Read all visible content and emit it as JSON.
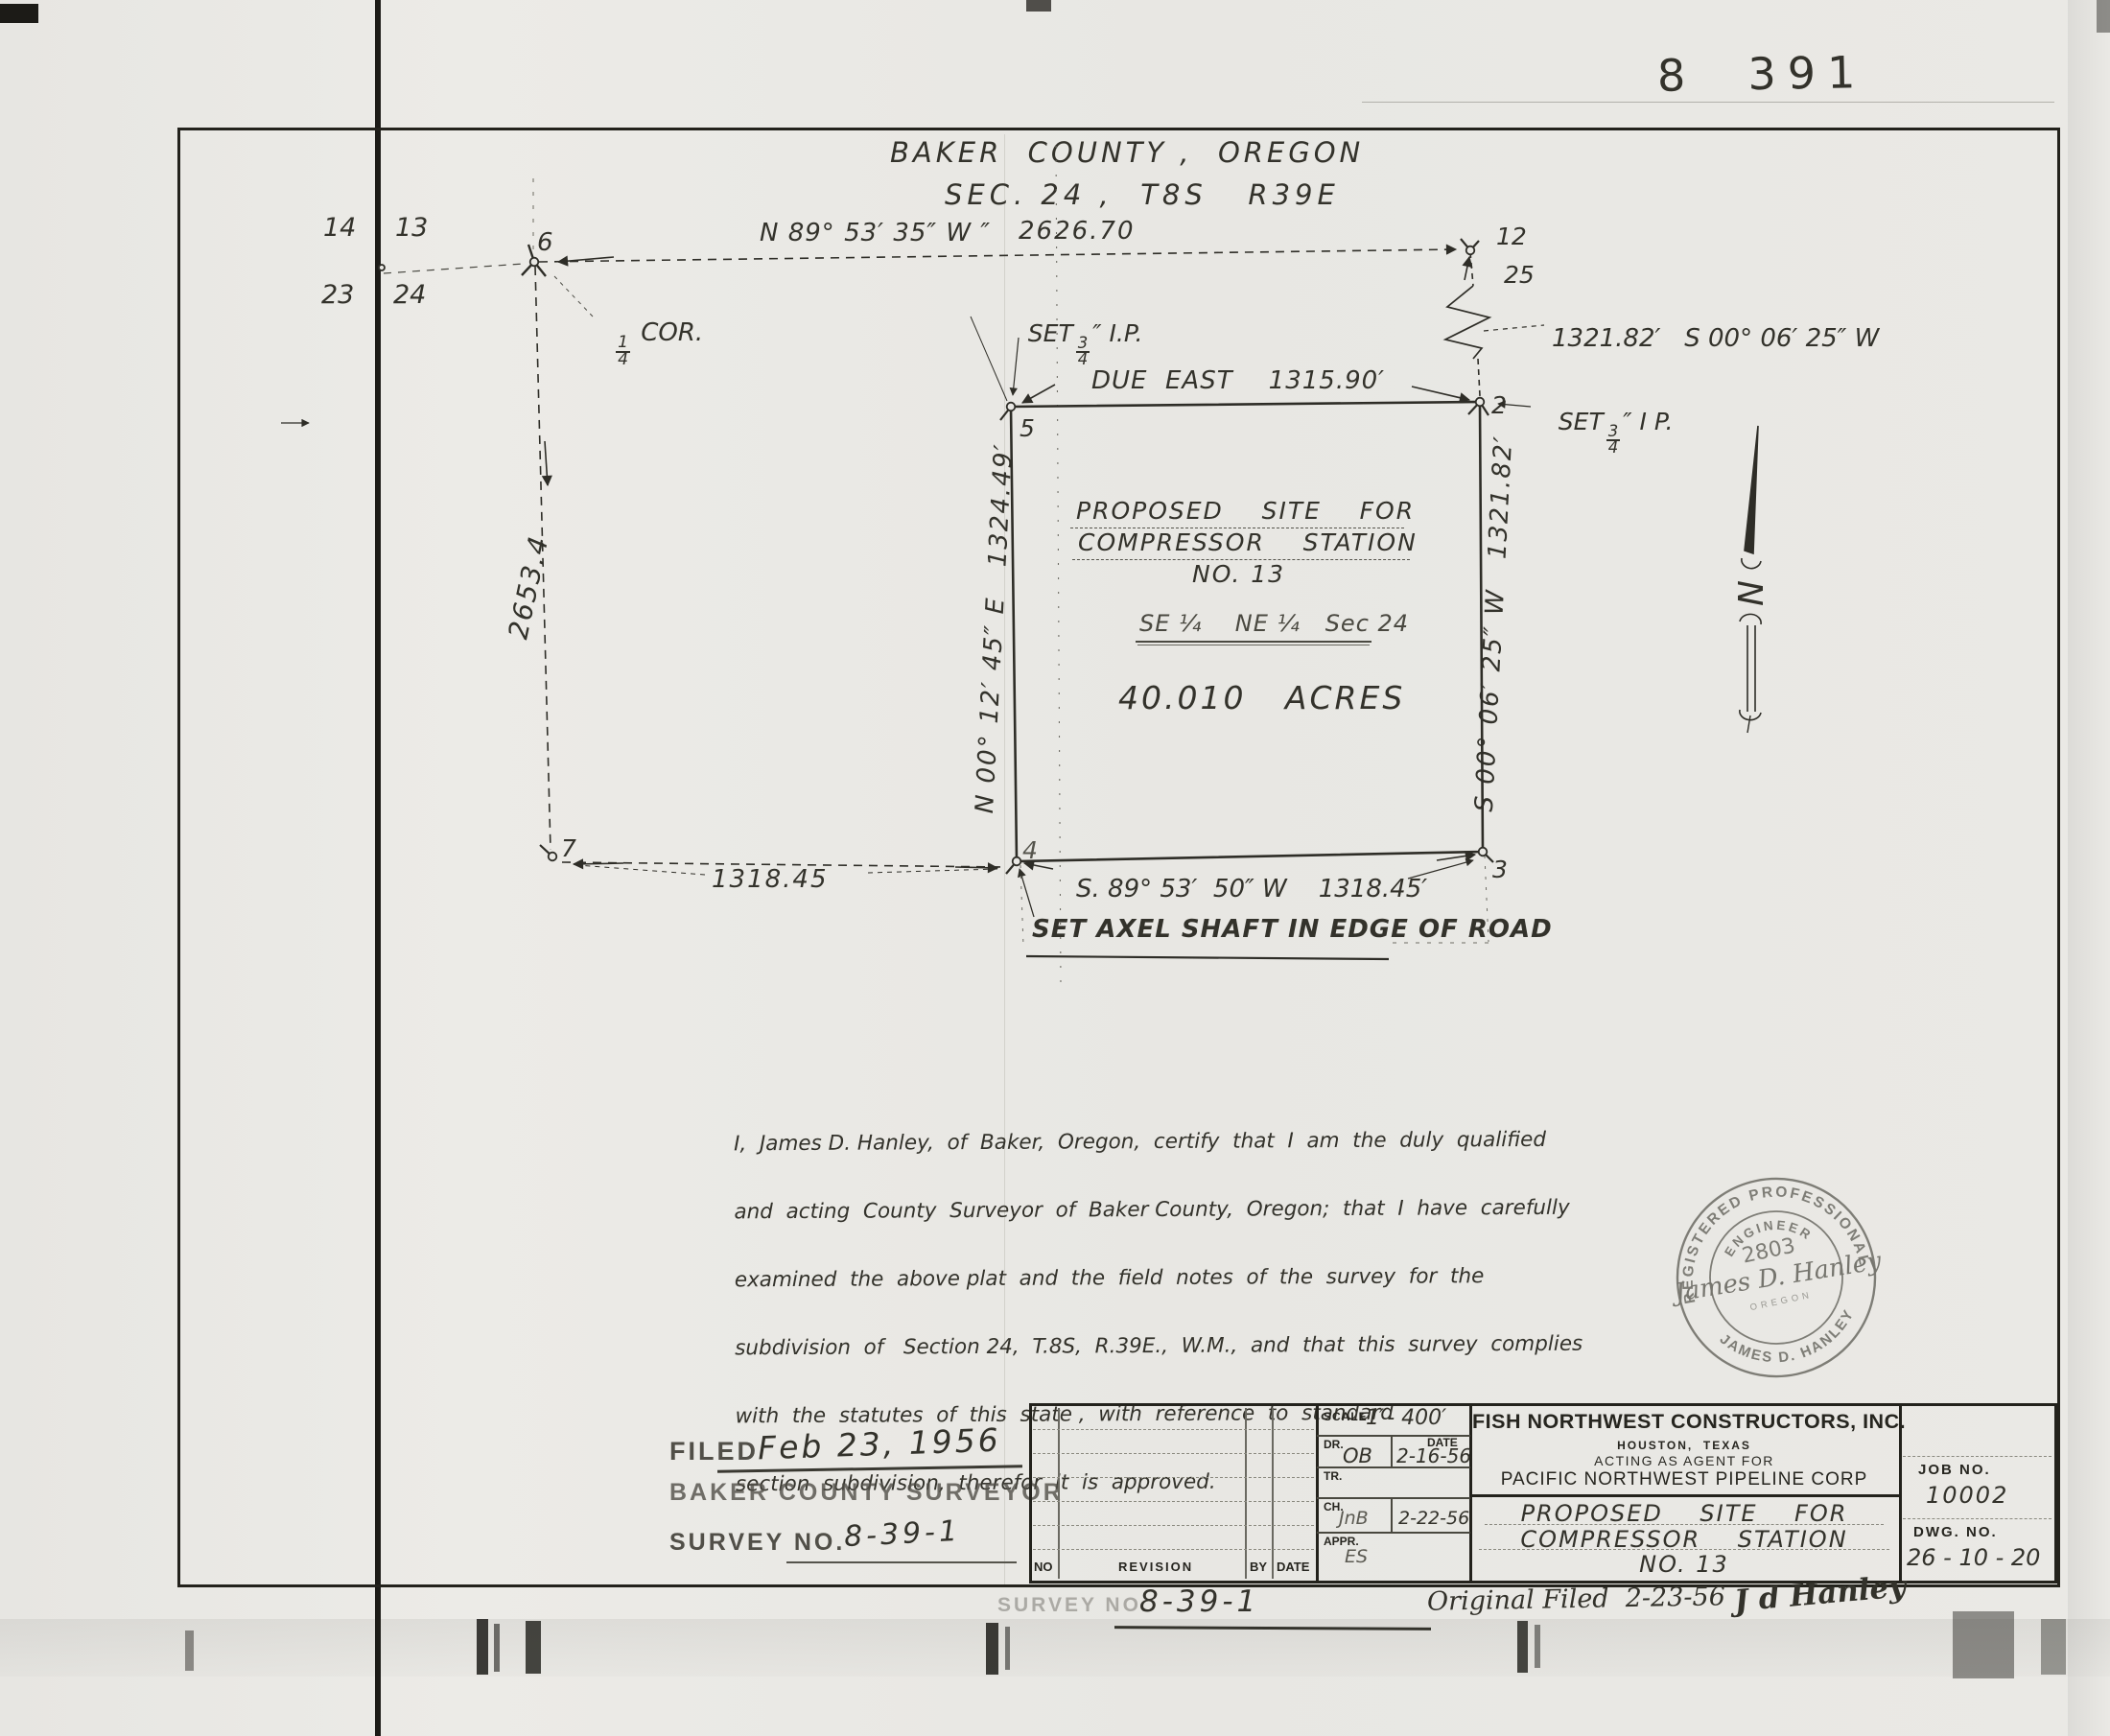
{
  "scan": {
    "sheet_number": "8  391"
  },
  "title": {
    "line1": "BAKER  COUNTY ,  OREGON",
    "line2": "SEC. 24 ,  T8S   R39E"
  },
  "sections": {
    "nw": "14",
    "ne": "13",
    "sw": "23",
    "se": "24",
    "quarter": {
      "num": "1",
      "den": "4",
      "suffix": " COR."
    }
  },
  "plat": {
    "north_line": {
      "bearing": "N 89° 53′ 35″ W ″",
      "distance": "2626.70"
    },
    "east_offset": "1321.82′   S 00° 06′ 25″ W",
    "set_ip_top": {
      "prefix": "SET",
      "num": "3",
      "den": "4",
      "suffix": "″ I.P."
    },
    "set_ip_right": {
      "prefix": "SET",
      "num": "3",
      "den": "4",
      "suffix": "″ I P."
    },
    "due_east": "DUE  EAST    1315.90′",
    "west_line": "N 00° 12′ 45″ E   1324.49′",
    "east_line": "S 00° 06′ 25″ W   1321.82′",
    "west_section_distance": "2653.4",
    "south_line": "S. 89° 53′  50″ W    1318.45′",
    "southwest_distance": "1318.45",
    "axel_note": "SET AXEL SHAFT IN EDGE OF ROAD",
    "site": {
      "line1": "PROPOSED    SITE    FOR",
      "line2": "COMPRESSOR    STATION",
      "line3": "NO. 13"
    },
    "aliquot": "SE ¼    NE ¼   Sec 24",
    "acreage": "40.010   ACRES",
    "north_label": "N",
    "points": {
      "p2": "2",
      "p3": "3",
      "p4": "4",
      "p5": "5",
      "p6": "6",
      "p7": "7",
      "p12": "12",
      "p25": "25"
    }
  },
  "certification": {
    "lines": [
      "I,  James D. Hanley,  of  Baker,  Oregon,  certify  that  I  am  the  duly  qualified",
      "and  acting  County  Surveyor  of  Baker County,  Oregon;  that  I  have  carefully",
      "examined  the  above plat  and  the  field  notes  of  the  survey  for  the",
      "subdivision  of   Section 24,  T.8S,  R.39E.,  W.M.,  and  that  this  survey  complies",
      "with  the  statutes  of  this  state ,  with  reference  to  standard",
      "section  subdivision,  therefor  it  is  approved."
    ]
  },
  "seal": {
    "arc_top": "REGISTERED PROFESSIONAL",
    "arc_engineer": "ENGINEER",
    "number": "2803",
    "signature": "James D. Hanley",
    "state": "OREGON",
    "arc_bottom": "JAMES  D.  HANLEY"
  },
  "filed_block": {
    "filed_label": "FILED",
    "filed_date": "Feb 23, 1956",
    "surveyor": "BAKER COUNTY SURVEYOR",
    "survey_no_label": "SURVEY NO.",
    "survey_no": "8-39-1"
  },
  "title_block": {
    "revision_headers": {
      "no": "NO",
      "revision": "REVISION",
      "by": "BY",
      "date": "DATE"
    },
    "scale_label": "SCALE",
    "scale_value": "1″- 400′",
    "dr_label": "DR.",
    "dr_value": "OB",
    "date_label": "DATE",
    "dr_date": "2-16-56",
    "tr_label": "TR.",
    "ch_label": "CH.",
    "ch_value": "JnB",
    "ch_date": "2-22-56",
    "appr_label": "APPR.",
    "appr_value": "ES",
    "company": "FISH NORTHWEST CONSTRUCTORS, INC.",
    "company_city": "HOUSTON,  TEXAS",
    "agent_line": "ACTING AS AGENT FOR",
    "client": "PACIFIC NORTHWEST PIPELINE CORP",
    "drawing_title": {
      "line1": "PROPOSED    SITE    FOR",
      "line2": "COMPRESSOR    STATION",
      "line3": "NO. 13"
    },
    "job_no_label": "JOB NO.",
    "job_no": "10002",
    "dwg_no_label": "DWG. NO.",
    "dwg_no": "26 - 10 - 20"
  },
  "footer": {
    "survey_no_label": "SURVEY NO.",
    "survey_no": "8-39-1",
    "original_filed": "Original Filed  2-23-56",
    "signature": "J d Hanley"
  }
}
